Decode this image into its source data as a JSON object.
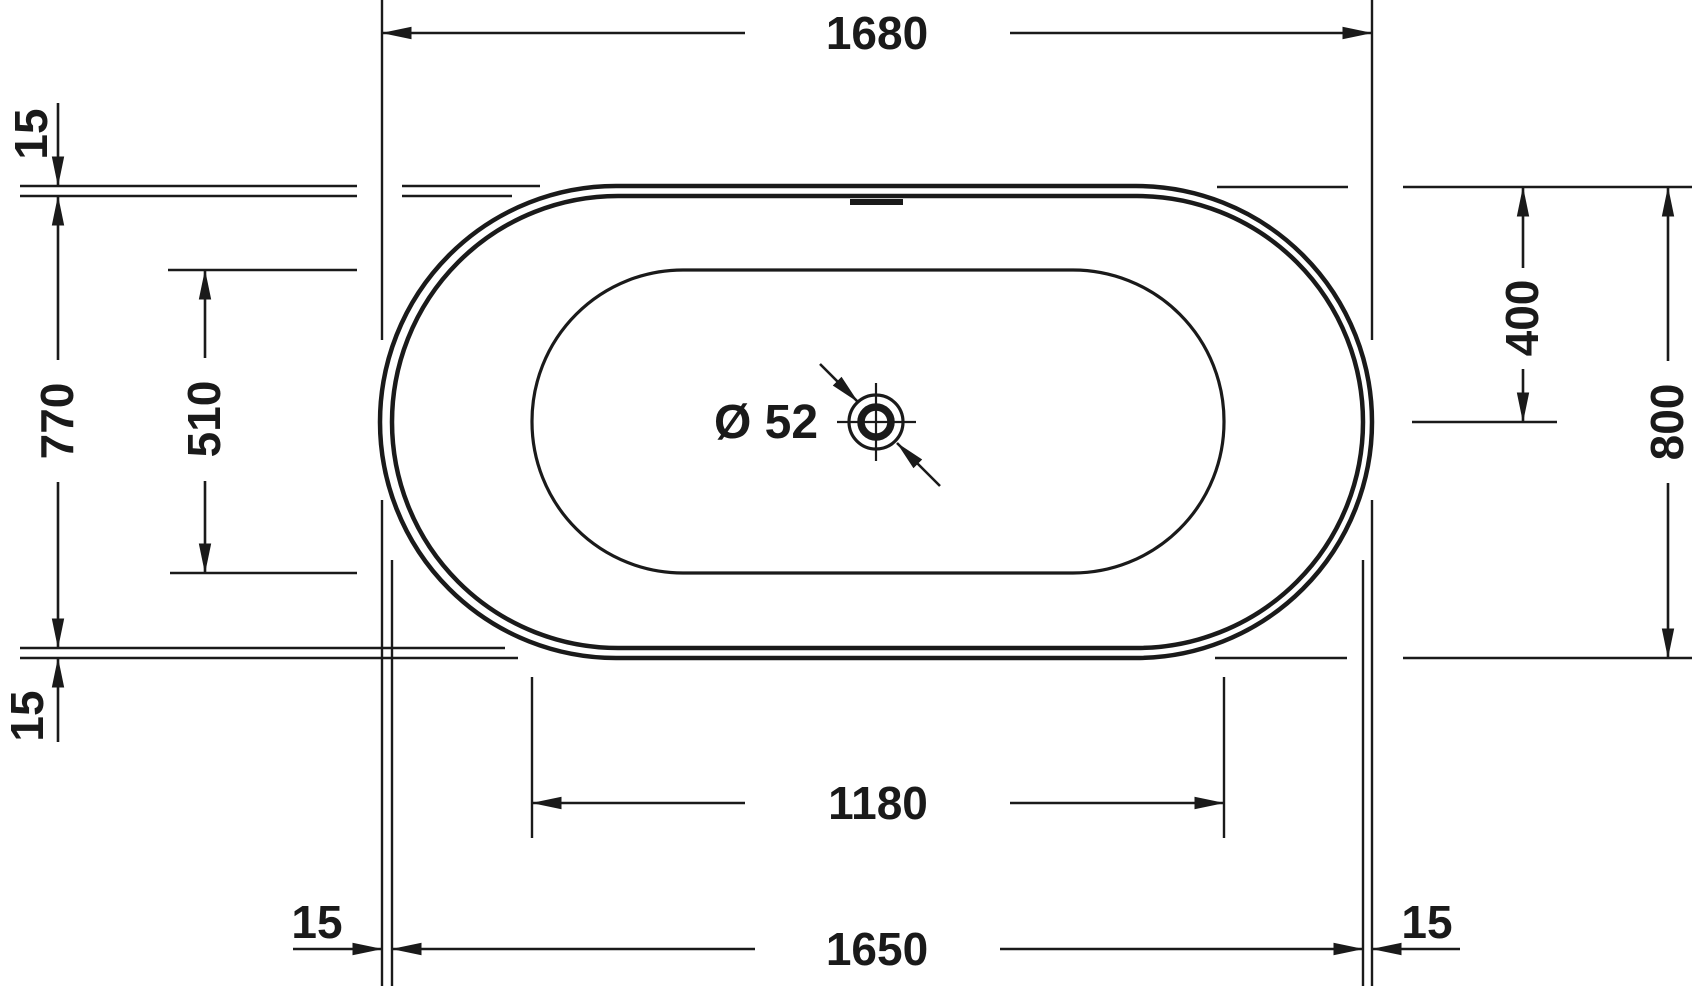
{
  "diagram": {
    "type": "technical-drawing",
    "subject": "bathtub top view with dimensions",
    "ink_color": "#1a1a1a",
    "background_color": "#ffffff",
    "dims": {
      "overall_length": "1680",
      "body_length": "1650",
      "basin_length": "1180",
      "overall_width": "800",
      "body_width": "770",
      "basin_width": "510",
      "center_offset": "400",
      "rim_offset_top_left": "15",
      "rim_offset_bottom_left": "15",
      "rim_offset_bottom_left_h": "15",
      "rim_offset_bottom_right_h": "15",
      "drain_diameter": "Ø 52"
    }
  }
}
